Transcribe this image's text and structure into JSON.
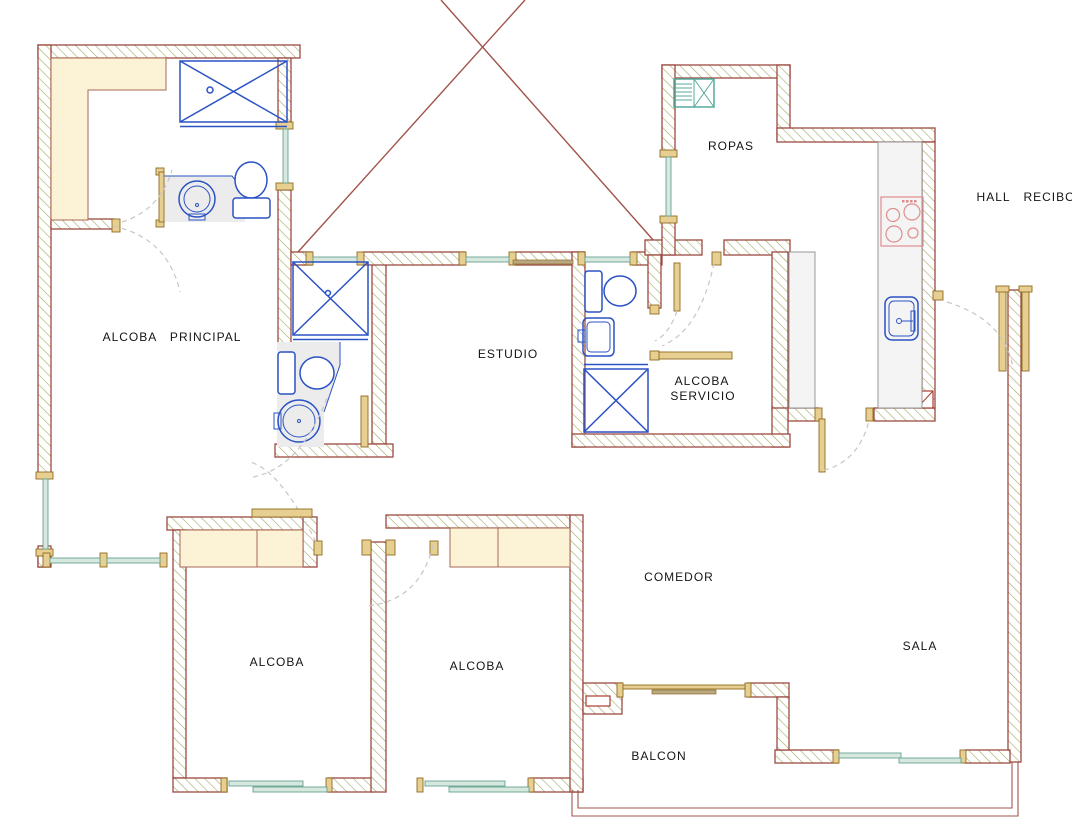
{
  "plan": {
    "type": "apartment-floor-plan",
    "rooms": [
      {
        "name": "alcoba-principal",
        "label": "ALCOBA PRINCIPAL"
      },
      {
        "name": "estudio",
        "label": "ESTUDIO"
      },
      {
        "name": "ropas",
        "label": "ROPAS"
      },
      {
        "name": "hall-recibo",
        "label": "HALL RECIBO"
      },
      {
        "name": "alcoba-servicio",
        "label_line1": "ALCOBA",
        "label_line2": "SERVICIO"
      },
      {
        "name": "comedor",
        "label": "COMEDOR"
      },
      {
        "name": "sala",
        "label": "SALA"
      },
      {
        "name": "alcoba-izquierda",
        "label": "ALCOBA"
      },
      {
        "name": "alcoba-centro",
        "label": "ALCOBA"
      },
      {
        "name": "balcon",
        "label": "BALCON"
      }
    ],
    "fixtures": [
      "shower",
      "toilet",
      "round-sink",
      "kitchen-sink",
      "stove-4-burners",
      "washer",
      "closet",
      "kitchen-counter",
      "sliding-window",
      "door-swing",
      "balcony-railing",
      "void-cross"
    ],
    "palette": {
      "wall_outline": "#9b4a40",
      "wall_hatch": "#a3a866",
      "closet_fill": "#fcf3d6",
      "window_glass": "#d7e8de",
      "window_frame": "#e7cf92",
      "fixture_blue": "#2a52c4",
      "laundry_teal": "#53ab9e",
      "stove_red": "#e08d8d",
      "counter_gray": "#f4f4f4",
      "void_line": "#a0524a",
      "swing_dash": "#c6c6c6"
    }
  }
}
